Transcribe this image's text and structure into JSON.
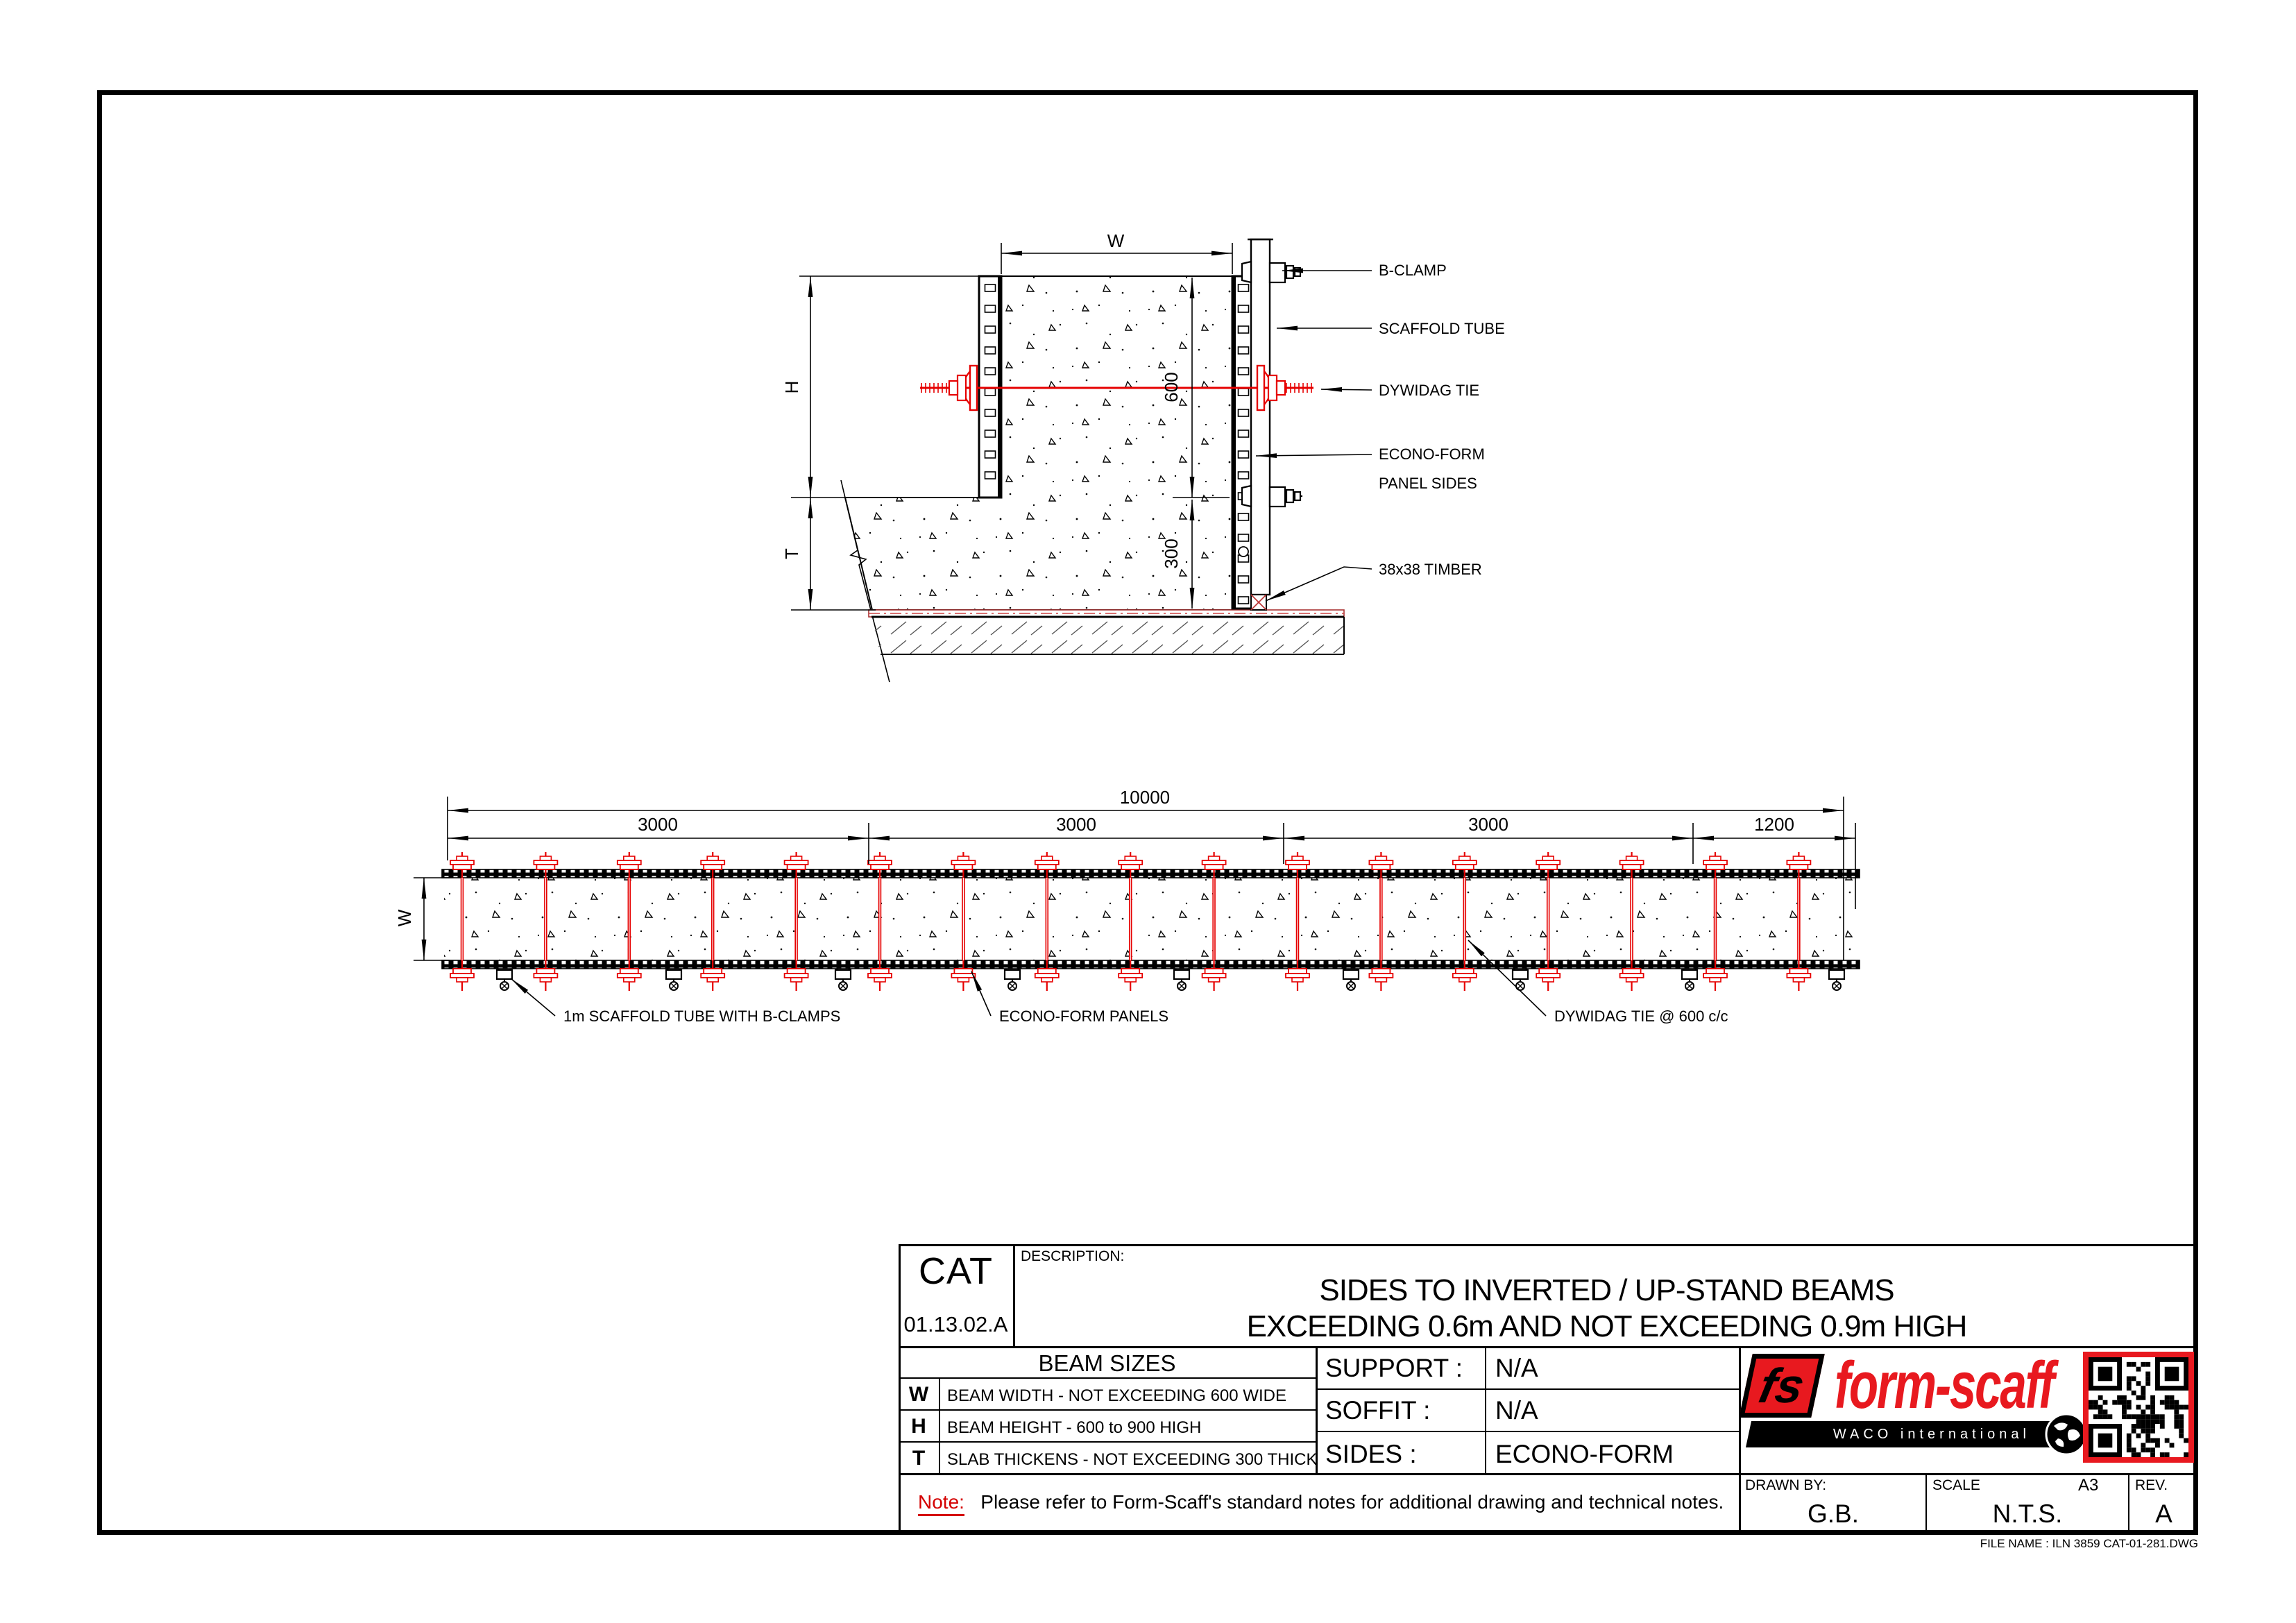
{
  "page": {
    "file_name": "FILE NAME : ILN 3859 CAT-01-281.DWG"
  },
  "colors": {
    "cad_red": "#e60000",
    "logo_red": "#e8191f",
    "line_black": "#000000"
  },
  "detail_view": {
    "dims": {
      "width": "W",
      "height": "H",
      "thickness": "T",
      "beam_height": "600",
      "slab_thickness": "300"
    },
    "labels": {
      "b_clamp": "B-CLAMP",
      "scaffold_tube": "SCAFFOLD TUBE",
      "dywidag_tie": "DYWIDAG TIE",
      "econoform_line1": "ECONO-FORM",
      "econoform_line2": "PANEL SIDES",
      "timber": "38x38 TIMBER"
    }
  },
  "plan_view": {
    "dims": {
      "total": "10000",
      "seg1": "3000",
      "seg2": "3000",
      "seg3": "3000",
      "seg4": "1200",
      "width": "W"
    },
    "labels": {
      "scaffold": "1m SCAFFOLD TUBE WITH B-CLAMPS",
      "panels": "ECONO-FORM PANELS",
      "tie": "DYWIDAG TIE @ 600 c/c"
    }
  },
  "title_block": {
    "cat": {
      "label": "CAT",
      "number": "01.13.02.A"
    },
    "description": {
      "label": "DESCRIPTION:",
      "line1": "SIDES TO INVERTED / UP-STAND BEAMS",
      "line2": "EXCEEDING 0.6m AND NOT EXCEEDING 0.9m HIGH"
    },
    "beam_sizes": {
      "title": "BEAM SIZES",
      "rows": [
        {
          "key": "W",
          "desc": "BEAM WIDTH - NOT EXCEEDING 600 WIDE"
        },
        {
          "key": "H",
          "desc": "BEAM HEIGHT - 600 to 900 HIGH"
        },
        {
          "key": "T",
          "desc": "SLAB THICKENS - NOT EXCEEDING 300 THICK"
        }
      ]
    },
    "specs": [
      {
        "label": "SUPPORT :",
        "value": "N/A"
      },
      {
        "label": "SOFFIT :",
        "value": "N/A"
      },
      {
        "label": "SIDES :",
        "value": "ECONO-FORM"
      }
    ],
    "note": {
      "label": "Note:",
      "text": "Please refer to Form-Scaff's standard notes for additional drawing and technical notes."
    },
    "drawn_by": {
      "label": "DRAWN BY:",
      "value": "G.B."
    },
    "scale": {
      "label": "SCALE",
      "value": "N.T.S.",
      "sheet": "A3"
    },
    "rev": {
      "label": "REV.",
      "value": "A"
    },
    "logo": {
      "monogram": "fs",
      "brand": "form-scaff",
      "sub": "WACO international"
    }
  }
}
